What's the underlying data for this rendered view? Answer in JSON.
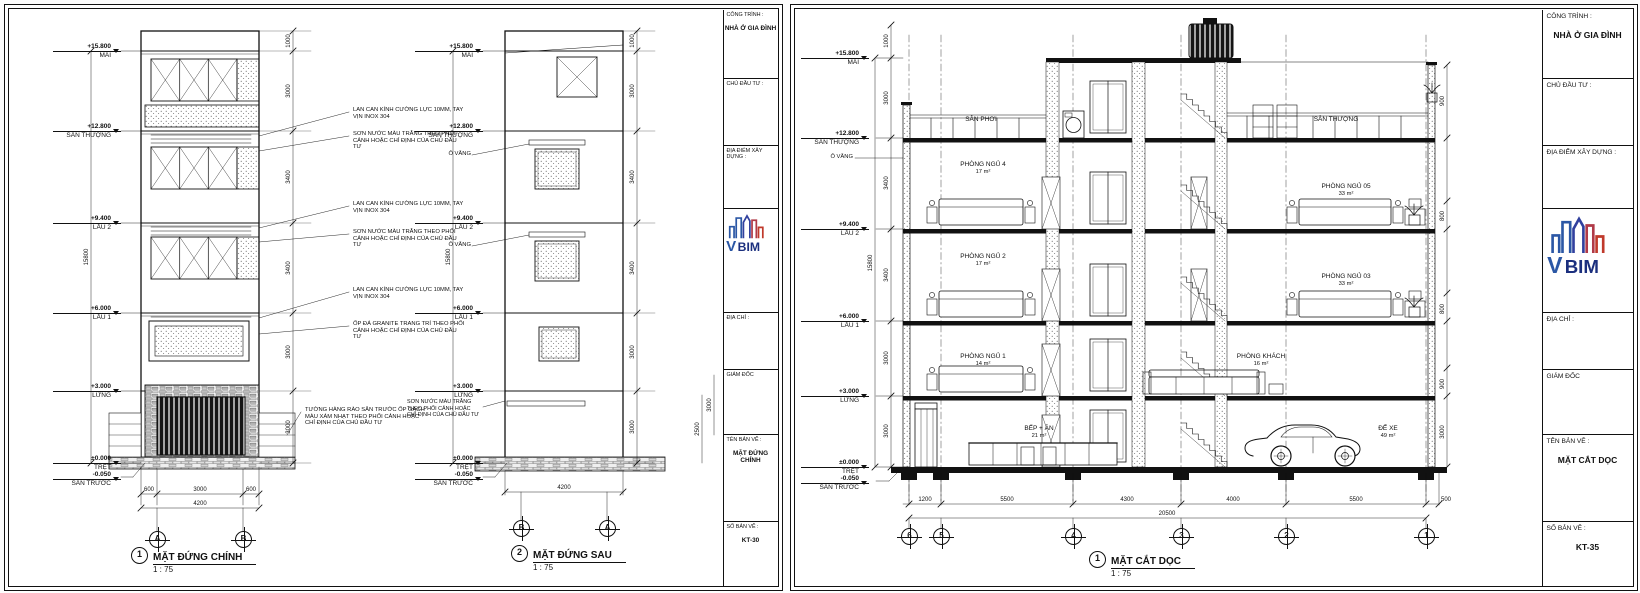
{
  "tb": {
    "cong_trinh": "CÔNG TRÌNH :",
    "project": "NHÀ Ở GIA ĐÌNH",
    "chu_dau_tu": "CHỦ ĐẦU TƯ :",
    "dia_diem": "ĐỊA ĐIỂM XÂY DỰNG :",
    "dia_chi": "ĐỊA CHỈ :",
    "giam_doc": "GIÁM ĐỐC",
    "ten_ban_ve": "TÊN BẢN VẼ :",
    "so_ban_ve": "SỐ BẢN VẼ :",
    "logo_v": "V",
    "logo_bim": "BIM"
  },
  "sheet_left": {
    "drawing_name": "MẶT ĐỨNG CHÍNH",
    "drawing_no": "KT-30"
  },
  "sheet_right": {
    "drawing_name": "MẶT CẮT DỌC",
    "drawing_no": "KT-35"
  },
  "levels": [
    {
      "elev": "+15.800",
      "name": "MÁI"
    },
    {
      "elev": "+12.800",
      "name": "SÂN THƯỢNG"
    },
    {
      "elev": "+9.400",
      "name": "LẦU 2"
    },
    {
      "elev": "+6.000",
      "name": "LẦU 1"
    },
    {
      "elev": "+3.000",
      "name": "LỬNG"
    },
    {
      "elev": "±0.000",
      "name": "TRỆT"
    },
    {
      "elev": "-0.050",
      "name": "SÂN TRƯỚC"
    }
  ],
  "dims": {
    "floor_heights": [
      "1000",
      "3000",
      "3400",
      "3400",
      "3000",
      "3000"
    ],
    "total_height": "15800"
  },
  "elev_front": {
    "number": "1",
    "title": "MẶT ĐỨNG CHÍNH",
    "scale": "1 : 75",
    "grids": [
      "A",
      "B"
    ],
    "bottom_dims": [
      "600",
      "3000",
      "600"
    ],
    "total_width": "4200",
    "notes": [
      "LAN CAN KÍNH CƯỜNG LỰC 10MM, TAY VỊN INOX 304",
      "SƠN NƯỚC MÀU TRẮNG THEO PHỐI CẢNH HOẶC CHỈ ĐỊNH CỦA CHỦ ĐẦU TƯ",
      "LAN CAN KÍNH CƯỜNG LỰC 10MM, TAY VỊN INOX 304",
      "SƠN NƯỚC MÀU TRẮNG THEO PHỐI CẢNH HOẶC CHỈ ĐỊNH CỦA CHỦ ĐẦU TƯ",
      "LAN CAN KÍNH CƯỜNG LỰC 10MM, TAY VỊN INOX 304",
      "ỐP ĐÁ GRANITE TRANG TRÍ THEO PHỐI CẢNH HOẶC CHỈ ĐỊNH CỦA CHỦ ĐẦU TƯ",
      "TƯỜNG HÀNG RÀO SÂN TRƯỚC ỐP GẠCH MÀU XÁM NHẠT THEO PHỐI CẢNH HOẶC CHỈ ĐỊNH CỦA CHỦ ĐẦU TƯ"
    ]
  },
  "elev_rear": {
    "number": "2",
    "title": "MẶT ĐỨNG SAU",
    "scale": "1 : 75",
    "grids": [
      "B",
      "A"
    ],
    "total_width": "4200",
    "o_vang": "Ô VĂNG",
    "note": "SƠN NƯỚC MÀU TRẮNG THEO PHỐI CẢNH HOẶC CHỈ ĐỊNH CỦA CHỦ ĐẦU TƯ",
    "side_dims": [
      "2500",
      "3000"
    ]
  },
  "section": {
    "number": "1",
    "title": "MẶT CẮT DỌC",
    "scale": "1 : 75",
    "o_vang": "Ô VĂNG",
    "grids": [
      "6",
      "5",
      "4",
      "3",
      "2",
      "1"
    ],
    "bottom_dims": [
      "1200",
      "5500",
      "4300",
      "4000",
      "5500",
      "500"
    ],
    "total_width": "20500",
    "right_dims": [
      "900",
      "800",
      "800",
      "900",
      "3000"
    ],
    "rooms": [
      {
        "name": "SÂN PHƠI",
        "area": ""
      },
      {
        "name": "SÂN THƯỢNG",
        "area": ""
      },
      {
        "name": "PHÒNG NGỦ 4",
        "area": "17 m²"
      },
      {
        "name": "PHÒNG NGỦ 05",
        "area": "33 m²"
      },
      {
        "name": "PHÒNG NGỦ 2",
        "area": "17 m²"
      },
      {
        "name": "PHÒNG NGỦ 03",
        "area": "33 m²"
      },
      {
        "name": "PHÒNG NGỦ 1",
        "area": "14 m²"
      },
      {
        "name": "PHÒNG KHÁCH",
        "area": "16 m²"
      },
      {
        "name": "BẾP + ĂN",
        "area": "21 m²"
      },
      {
        "name": "ĐỂ XE",
        "area": "49 m²"
      }
    ]
  },
  "colors": {
    "line": "#111111",
    "logo_blue": "#2b57a5",
    "logo_navy": "#1b2f7e",
    "logo_red": "#c0392b"
  }
}
